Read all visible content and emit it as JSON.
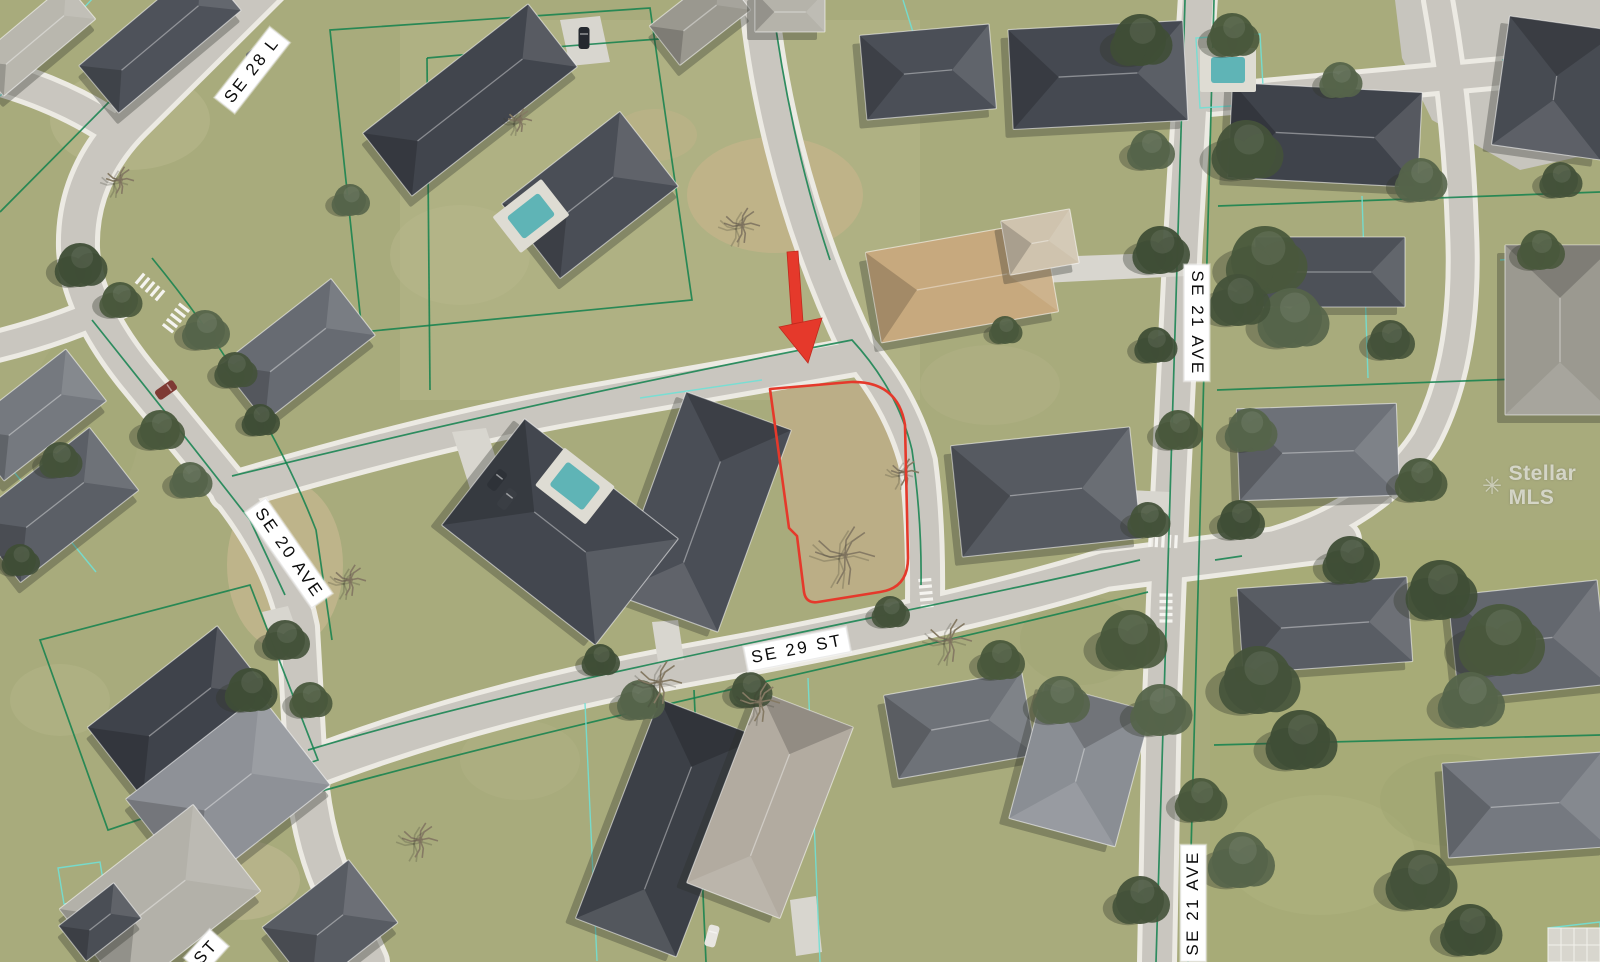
{
  "map": {
    "street_labels": [
      {
        "id": "se28_top",
        "text": "SE 28 L"
      },
      {
        "id": "se20_ave",
        "text": "SE 20 AVE"
      },
      {
        "id": "se29_st",
        "text": "SE 29 ST"
      },
      {
        "id": "se21_ave_top",
        "text": "SE 21 AVE"
      },
      {
        "id": "se21_ave_bottom",
        "text": "SE 21 AVE"
      },
      {
        "id": "partial_st_bottom_left",
        "text": "ST"
      }
    ],
    "watermark": {
      "text": "Stellar MLS",
      "logo": "starburst-icon"
    },
    "colors": {
      "highlight_red": "#e5392b",
      "parcel_line_green": "#12814e",
      "parcel_line_cyan": "#70e0d5",
      "road": "#c9c6bf",
      "sidewalk": "#eceae3",
      "lawn": "#a8ab7c"
    }
  }
}
